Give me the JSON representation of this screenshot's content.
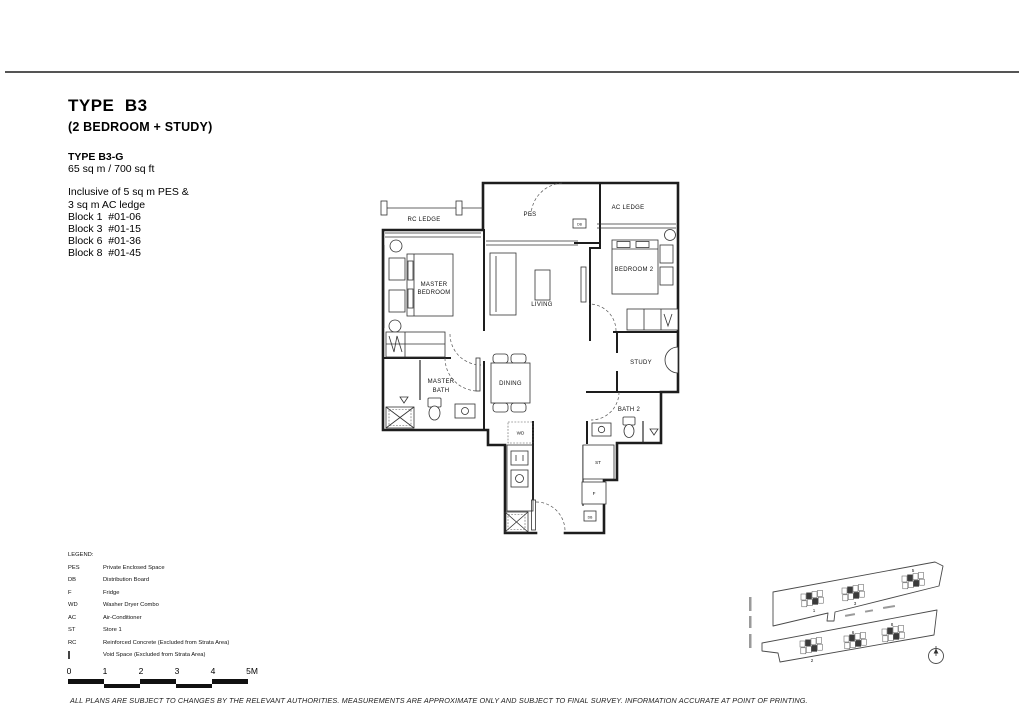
{
  "header": {
    "title": "TYPE  B3",
    "subtitle": "(2 BEDROOM + STUDY)"
  },
  "unit_info": {
    "variant": "TYPE B3-G",
    "area": "65 sq m / 700 sq ft",
    "inclusive": [
      "Inclusive of 5 sq m PES &",
      "3 sq m AC ledge"
    ],
    "blocks": [
      "Block 1  #01-06",
      "Block 3  #01-15",
      "Block 6  #01-36",
      "Block 8  #01-45"
    ]
  },
  "floorplan": {
    "labels": {
      "rc_ledge": "RC LEDGE",
      "pes": "PES",
      "ac_ledge": "AC LEDGE",
      "master_bed_l1": "MASTER",
      "master_bed_l2": "BEDROOM",
      "bedroom2": "BEDROOM 2",
      "living": "LIVING",
      "study": "STUDY",
      "master_bath_l1": "MASTER",
      "master_bath_l2": "BATH",
      "dining": "DINING",
      "bath2": "BATH 2",
      "wd": "WD",
      "st": "ST",
      "f": "F",
      "db": "DB"
    }
  },
  "legend": {
    "title": "LEGEND:",
    "items": [
      {
        "abbr": "PES",
        "desc": "Private Enclosed Space"
      },
      {
        "abbr": "DB",
        "desc": "Distribution Board"
      },
      {
        "abbr": "F",
        "desc": "Fridge"
      },
      {
        "abbr": "WD",
        "desc": "Washer Dryer Combo"
      },
      {
        "abbr": "AC",
        "desc": "Air-Conditioner"
      },
      {
        "abbr": "ST",
        "desc": "Store 1"
      },
      {
        "abbr": "RC",
        "desc": "Reinforced Concrete (Excluded from Strata Area)"
      },
      {
        "abbr": "",
        "desc": "Void Space (Excluded from Strata Area)",
        "icon": "void-space-icon"
      }
    ]
  },
  "scale_bar": {
    "ticks": [
      "0",
      "1",
      "2",
      "3",
      "4",
      "5M"
    ]
  },
  "site_plan": {
    "top_blocks": [
      "1",
      "3",
      "5"
    ],
    "bottom_blocks": [
      "2",
      "6",
      "8"
    ]
  },
  "footer": {
    "disclaimer": "ALL PLANS ARE SUBJECT TO CHANGES BY THE RELEVANT AUTHORITIES. MEASUREMENTS ARE APPROXIMATE ONLY AND SUBJECT TO FINAL SURVEY. INFORMATION ACCURATE AT POINT OF PRINTING."
  }
}
